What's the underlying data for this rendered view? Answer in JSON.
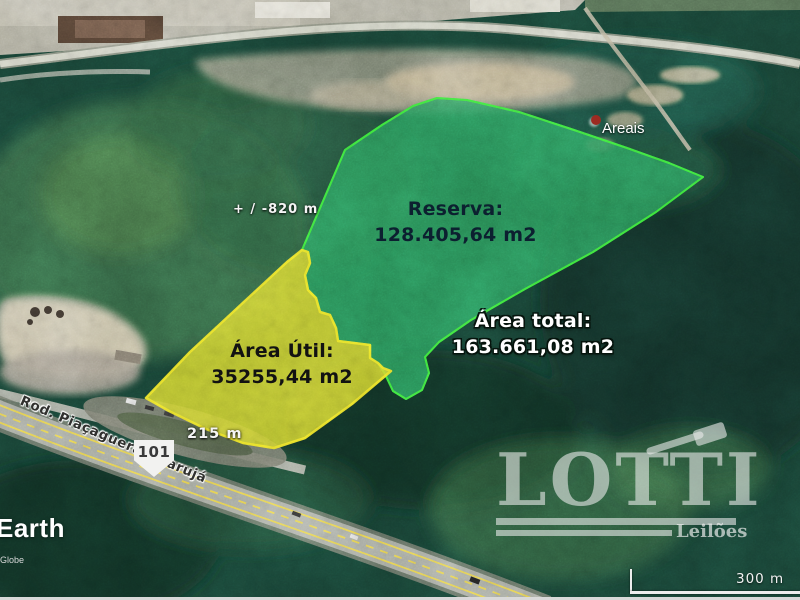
{
  "annotations": {
    "reserva": {
      "title": "Reserva:",
      "area": "128.405,64 m2"
    },
    "area_util": {
      "title": "Área Útil:",
      "area": "35255,44 m2"
    },
    "area_total": {
      "title": "Área total:",
      "area": "163.661,08 m2"
    },
    "depth_measure": "+ / -820 m",
    "front_measure": "215 m"
  },
  "map": {
    "place_marker": "Areais",
    "road_name": "Rod. Piaçaguera-Guarujá",
    "road_shield": "101",
    "scale_label": "300 m",
    "imagery_brand": "Earth",
    "attribution_fragment": "Globe"
  },
  "overlay_colors": {
    "reserva_fill": "#2b9c5c",
    "reserva_border": "#3cf03c",
    "area_util_fill": "#d6d92f",
    "area_util_border": "#f4ea28"
  },
  "watermark": {
    "brand": "LOTTI",
    "tagline": "Leilões"
  }
}
